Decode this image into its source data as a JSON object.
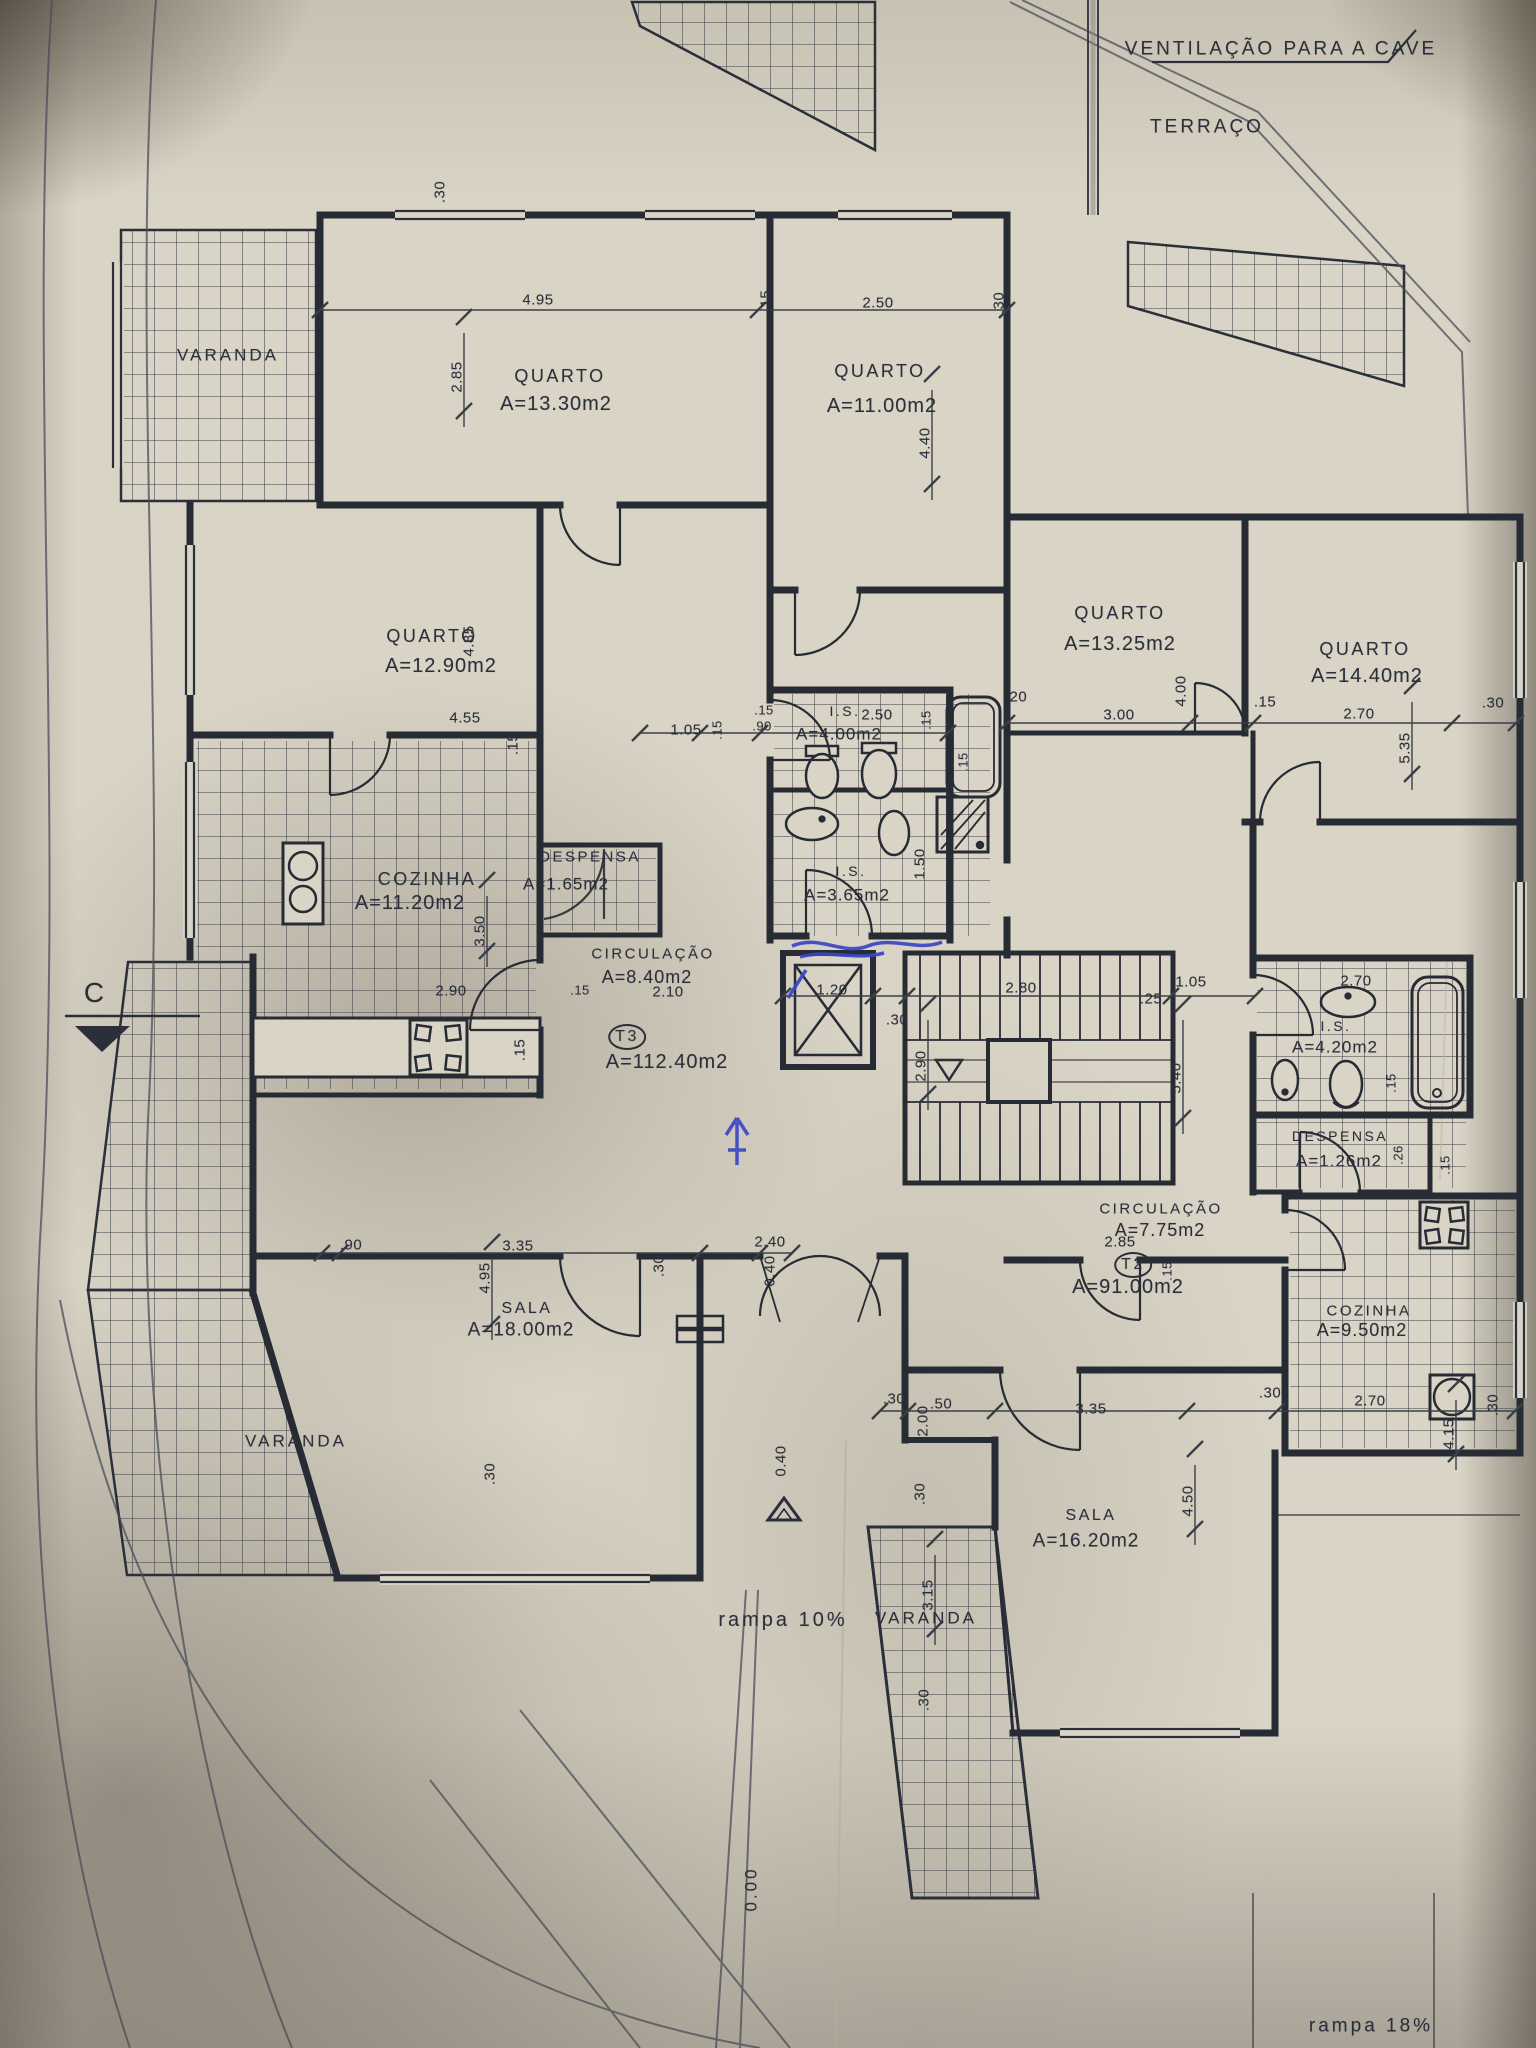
{
  "colors": {
    "ink": "#2b2f3a",
    "paper": "#d9d4c6",
    "pen_blue": "#3a46c4",
    "tile_line": "#3a3e47"
  },
  "notes": [
    {
      "t": "VENTILAÇÃO PARA A CAVE",
      "x": 1281,
      "y": 49,
      "s": 19
    },
    {
      "t": "TERRAÇO",
      "x": 1207,
      "y": 127,
      "s": 19
    },
    {
      "t": "rampa 10%",
      "x": 783,
      "y": 1620,
      "s": 20,
      "cls": "ramp"
    },
    {
      "t": "rampa 18%",
      "x": 1371,
      "y": 2026,
      "s": 19,
      "cls": "ramp"
    },
    {
      "t": "C",
      "x": 94,
      "y": 993,
      "s": 28,
      "cls": "section"
    },
    {
      "t": "0.00",
      "x": 751,
      "y": 1889,
      "s": 17,
      "r": 1
    }
  ],
  "varandas": [
    {
      "t": "VARANDA",
      "x": 228,
      "y": 355
    },
    {
      "t": "VARANDA",
      "x": 296,
      "y": 1441
    },
    {
      "t": "VARANDA",
      "x": 926,
      "y": 1618
    }
  ],
  "units": [
    {
      "id": "T3",
      "area": "A=112.40m2",
      "cx": 627,
      "cy": 1037,
      "ax": 667,
      "ay": 1062
    },
    {
      "id": "T2",
      "area": "A=91.00m2",
      "cx": 1133,
      "cy": 1265,
      "ax": 1128,
      "ay": 1287
    }
  ],
  "rooms": [
    {
      "name": "QUARTO",
      "area": "A=13.30m2",
      "nx": 560,
      "ny": 376,
      "ax": 556,
      "ay": 404
    },
    {
      "name": "QUARTO",
      "area": "A=11.00m2",
      "nx": 880,
      "ny": 371,
      "ax": 882,
      "ay": 406
    },
    {
      "name": "QUARTO",
      "area": "A=12.90m2",
      "nx": 432,
      "ny": 636,
      "ax": 441,
      "ay": 666
    },
    {
      "name": "QUARTO",
      "area": "A=13.25m2",
      "nx": 1120,
      "ny": 613,
      "ax": 1120,
      "ay": 644
    },
    {
      "name": "QUARTO",
      "area": "A=14.40m2",
      "nx": 1365,
      "ny": 649,
      "ax": 1367,
      "ay": 676
    },
    {
      "name": "COZINHA",
      "area": "A=11.20m2",
      "nx": 427,
      "ny": 879,
      "ax": 410,
      "ay": 903
    },
    {
      "name": "DESPENSA",
      "area": "A=1.65m2",
      "nx": 590,
      "ny": 857,
      "ax": 566,
      "ay": 884,
      "ns": 15,
      "as": 17
    },
    {
      "name": "CIRCULAÇÃO",
      "area": "A=8.40m2",
      "nx": 653,
      "ny": 954,
      "ax": 647,
      "ay": 977,
      "ns": 15,
      "as": 18
    },
    {
      "name": "I.S.",
      "area": "A=4.00m2",
      "nx": 845,
      "ny": 711,
      "ax": 839,
      "ay": 734,
      "ns": 14,
      "as": 17
    },
    {
      "name": "I.S.",
      "area": "A=3.65m2",
      "nx": 851,
      "ny": 871,
      "ax": 847,
      "ay": 895,
      "ns": 14,
      "as": 17
    },
    {
      "name": "I.S.",
      "area": "A=4.20m2",
      "nx": 1336,
      "ny": 1026,
      "ax": 1335,
      "ay": 1047,
      "ns": 14,
      "as": 17
    },
    {
      "name": "DESPENSA",
      "area": "A=1.26m2",
      "nx": 1340,
      "ny": 1136,
      "ax": 1339,
      "ay": 1161,
      "ns": 14,
      "as": 17
    },
    {
      "name": "CIRCULAÇÃO",
      "area": "A=7.75m2",
      "nx": 1161,
      "ny": 1209,
      "ax": 1160,
      "ay": 1230,
      "ns": 15,
      "as": 18
    },
    {
      "name": "COZINHA",
      "area": "A=9.50m2",
      "nx": 1369,
      "ny": 1311,
      "ax": 1362,
      "ay": 1330,
      "ns": 15,
      "as": 18
    },
    {
      "name": "SALA",
      "area": "A=18.00m2",
      "nx": 527,
      "ny": 1309,
      "ax": 521,
      "ay": 1330,
      "ns": 16,
      "as": 19
    },
    {
      "name": "SALA",
      "area": "A=16.20m2",
      "nx": 1091,
      "ny": 1516,
      "ax": 1086,
      "ay": 1541,
      "ns": 16,
      "as": 19
    }
  ],
  "dims": [
    {
      "t": ".30",
      "x": 440,
      "y": 192,
      "r": 1
    },
    {
      "t": "4.95",
      "x": 538,
      "y": 300
    },
    {
      "t": ".15",
      "x": 766,
      "y": 301,
      "r": 1
    },
    {
      "t": "2.50",
      "x": 878,
      "y": 303
    },
    {
      "t": ".30",
      "x": 999,
      "y": 303,
      "r": 1
    },
    {
      "t": "2.85",
      "x": 457,
      "y": 377,
      "r": 1
    },
    {
      "t": "4.40",
      "x": 925,
      "y": 443,
      "r": 1
    },
    {
      "t": "4.85",
      "x": 469,
      "y": 641,
      "r": 1
    },
    {
      "t": "4.55",
      "x": 465,
      "y": 718
    },
    {
      "t": ".15",
      "x": 513,
      "y": 744,
      "r": 1
    },
    {
      "t": "1.05",
      "x": 686,
      "y": 730
    },
    {
      "t": ".15",
      "x": 717,
      "y": 730,
      "r": 1,
      "s": 13
    },
    {
      "t": ".15",
      "x": 764,
      "y": 710,
      "s": 13
    },
    {
      "t": ".90",
      "x": 762,
      "y": 726,
      "s": 13
    },
    {
      "t": "2.50",
      "x": 877,
      "y": 715
    },
    {
      "t": ".15",
      "x": 926,
      "y": 720,
      "r": 1,
      "s": 13
    },
    {
      "t": ".20",
      "x": 1016,
      "y": 697
    },
    {
      "t": "3.00",
      "x": 1119,
      "y": 715
    },
    {
      "t": "4.00",
      "x": 1181,
      "y": 691,
      "r": 1
    },
    {
      "t": ".15",
      "x": 1265,
      "y": 702
    },
    {
      "t": "2.70",
      "x": 1359,
      "y": 714
    },
    {
      "t": "5.35",
      "x": 1405,
      "y": 748,
      "r": 1
    },
    {
      "t": ".30",
      "x": 1493,
      "y": 703
    },
    {
      "t": "1.50",
      "x": 920,
      "y": 864,
      "r": 1
    },
    {
      "t": ".15",
      "x": 963,
      "y": 762,
      "r": 1,
      "s": 13
    },
    {
      "t": "2.90",
      "x": 451,
      "y": 991
    },
    {
      "t": ".15",
      "x": 580,
      "y": 990,
      "s": 13
    },
    {
      "t": "3.50",
      "x": 480,
      "y": 931,
      "r": 1
    },
    {
      "t": ".15",
      "x": 520,
      "y": 1050,
      "r": 1
    },
    {
      "t": "2.10",
      "x": 668,
      "y": 992
    },
    {
      "t": "1.20",
      "x": 832,
      "y": 990
    },
    {
      "t": ".30",
      "x": 897,
      "y": 1020
    },
    {
      "t": "2.80",
      "x": 1021,
      "y": 988
    },
    {
      "t": ".25",
      "x": 1151,
      "y": 999
    },
    {
      "t": "1.05",
      "x": 1191,
      "y": 982
    },
    {
      "t": "2.90",
      "x": 921,
      "y": 1066,
      "r": 1
    },
    {
      "t": "5.40",
      "x": 1176,
      "y": 1078,
      "r": 1
    },
    {
      "t": "2.70",
      "x": 1356,
      "y": 981
    },
    {
      "t": ".15",
      "x": 1391,
      "y": 1083,
      "r": 1,
      "s": 13
    },
    {
      "t": ".26",
      "x": 1398,
      "y": 1155,
      "r": 1,
      "s": 13
    },
    {
      "t": ".15",
      "x": 1445,
      "y": 1165,
      "r": 1,
      "s": 13
    },
    {
      "t": "2.85",
      "x": 1120,
      "y": 1242
    },
    {
      "t": ".15",
      "x": 1167,
      "y": 1271,
      "r": 1,
      "s": 13
    },
    {
      "t": ".90",
      "x": 351,
      "y": 1245
    },
    {
      "t": "3.35",
      "x": 518,
      "y": 1246
    },
    {
      "t": "4.95",
      "x": 485,
      "y": 1278,
      "r": 1
    },
    {
      "t": ".30",
      "x": 659,
      "y": 1266,
      "r": 1
    },
    {
      "t": "2.40",
      "x": 770,
      "y": 1242
    },
    {
      "t": "0.40",
      "x": 770,
      "y": 1271,
      "r": 1
    },
    {
      "t": ".30",
      "x": 490,
      "y": 1474,
      "r": 1
    },
    {
      "t": "0.40",
      "x": 781,
      "y": 1461,
      "r": 1
    },
    {
      "t": ".30",
      "x": 894,
      "y": 1399
    },
    {
      "t": "2.00",
      "x": 923,
      "y": 1421,
      "r": 1
    },
    {
      "t": ".50",
      "x": 941,
      "y": 1404
    },
    {
      "t": ".30",
      "x": 920,
      "y": 1494,
      "r": 1
    },
    {
      "t": "3.35",
      "x": 1091,
      "y": 1409
    },
    {
      "t": "4.50",
      "x": 1188,
      "y": 1501,
      "r": 1
    },
    {
      "t": ".30",
      "x": 1270,
      "y": 1393
    },
    {
      "t": "2.70",
      "x": 1370,
      "y": 1401
    },
    {
      "t": ".30",
      "x": 1493,
      "y": 1405,
      "r": 1
    },
    {
      "t": "4.15",
      "x": 1449,
      "y": 1434,
      "r": 1
    },
    {
      "t": "3.15",
      "x": 928,
      "y": 1595,
      "r": 1
    },
    {
      "t": ".30",
      "x": 924,
      "y": 1700,
      "r": 1
    }
  ]
}
